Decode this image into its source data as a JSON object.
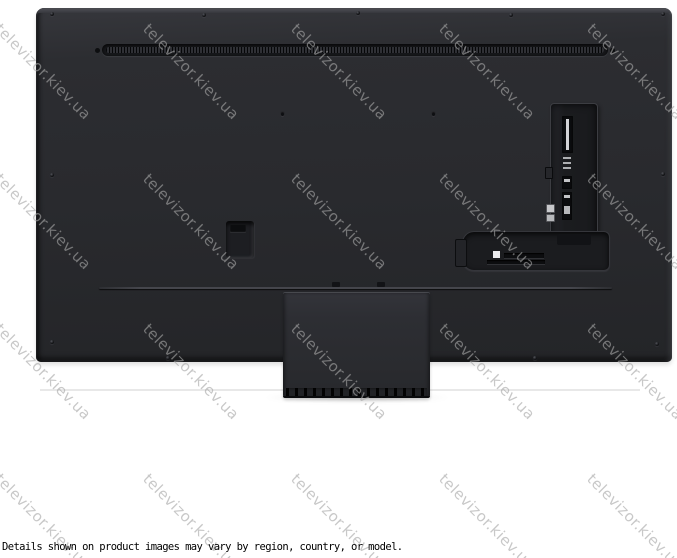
{
  "colors": {
    "background": "#ffffff",
    "tv-body-top": "#36373c",
    "tv-body": "#292a2e",
    "tv-body-bottom": "#242528",
    "panel-recess": "#1b1c1f",
    "stand": "#2d2e33",
    "stand-base": "#121316",
    "watermark": "#a7a7a7",
    "shadow-line": "#e8e8e8",
    "disclaimer-text": "#000000"
  },
  "watermark": {
    "text": "televizor.kiev.ua",
    "rotation_deg": 45,
    "opacity": 0.62,
    "grid": {
      "origin_x": 4,
      "origin_y": 20,
      "step_x": 148,
      "step_y": 150,
      "cols": 5,
      "rows": 4
    }
  },
  "disclaimer": {
    "text": "Details shown on product images may vary by region, country, or model."
  },
  "product": {
    "view": "tv-rear-panel-with-center-stand"
  }
}
